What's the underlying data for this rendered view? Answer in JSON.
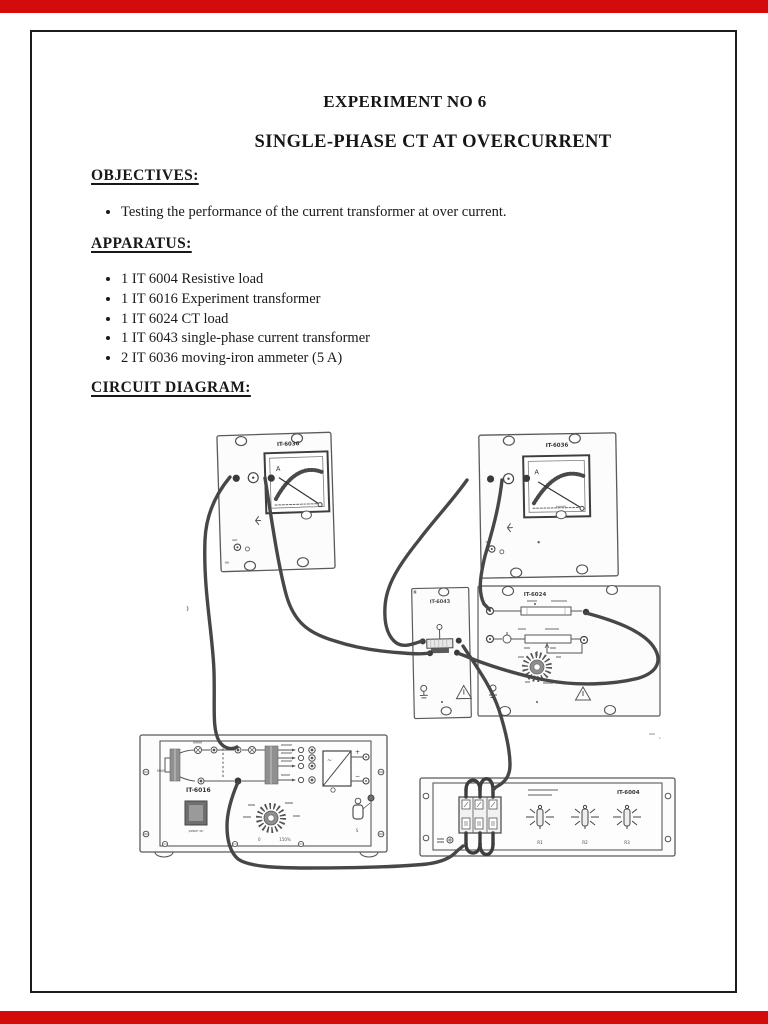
{
  "document": {
    "title": "EXPERIMENT NO 6",
    "subtitle": "SINGLE-PHASE CT AT OVERCURRENT",
    "objectives": {
      "heading": "OBJECTIVES:",
      "items": [
        "Testing the performance of the current transformer at over current."
      ]
    },
    "apparatus": {
      "heading": "APPARATUS:",
      "items": [
        "1 IT 6004 Resistive load",
        "1 IT 6016 Experiment transformer",
        "1 IT 6024 CT load",
        "1 IT 6043 single-phase current transformer",
        "2 IT 6036 moving-iron ammeter (5 A)"
      ]
    },
    "circuit_heading": "CIRCUIT DIAGRAM:"
  },
  "diagram": {
    "ammeter_left": {
      "label": "IT-6036",
      "meter_letter": "A"
    },
    "ammeter_right": {
      "label": "IT-6036",
      "meter_letter": "A"
    },
    "current_transformer": {
      "label": "IT-6043"
    },
    "ct_load": {
      "label": "IT-6024"
    },
    "experiment_transformer": {
      "label": "IT-6016",
      "power_label": "power on",
      "main_label": "MAIN",
      "switch_label": "S",
      "dial_zero": "0",
      "dial_max": "150%",
      "plus": "+",
      "minus": "−",
      "ac": "~"
    },
    "resistive_load": {
      "label": "IT-6004",
      "rheostat_labels": [
        "R1",
        "R2",
        "R3"
      ]
    }
  },
  "colors": {
    "accent_red": "#d40b0b",
    "page_border": "#1c1c1c",
    "scan_gray": "#555555"
  }
}
